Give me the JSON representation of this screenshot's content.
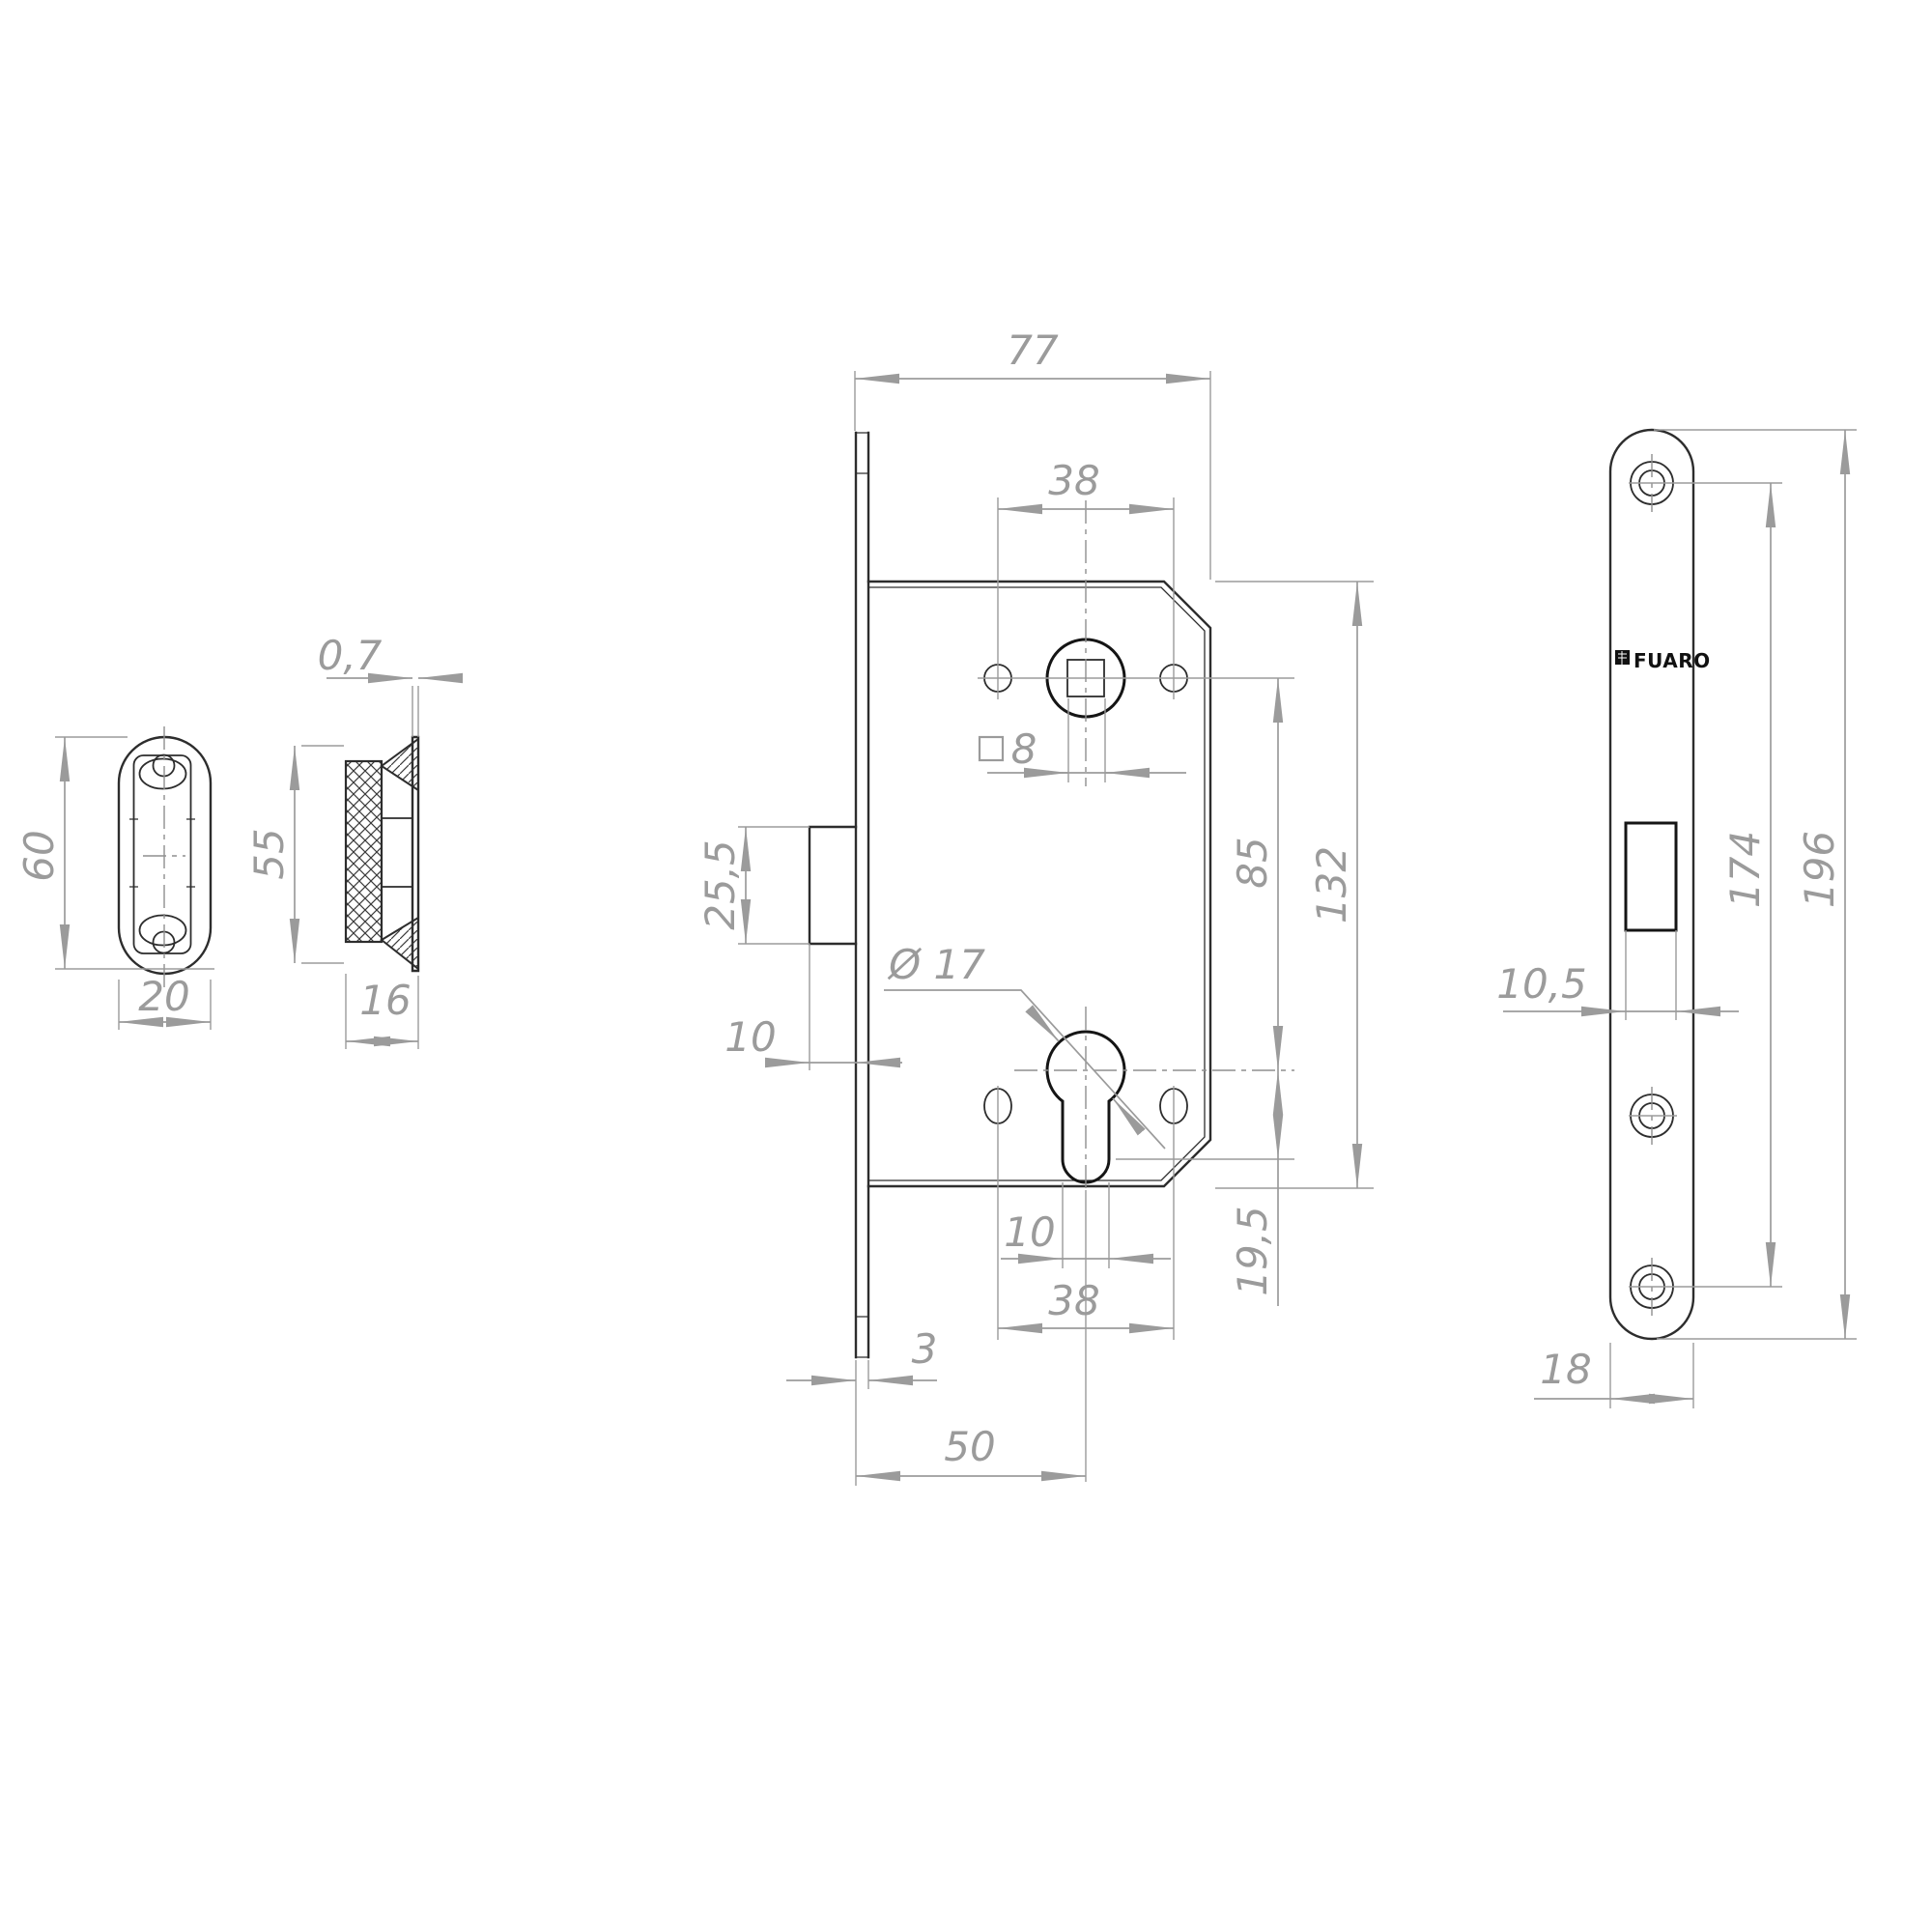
{
  "brand": {
    "logo_text": "FUARO"
  },
  "dims": {
    "strike_front": {
      "height": "60",
      "width": "20"
    },
    "strike_side": {
      "lip_thickness": "0,7",
      "height": "55",
      "depth": "16"
    },
    "lock_body": {
      "width": "77",
      "handle_holes_spacing": "38",
      "spindle_square": "8",
      "latch_height": "25,5",
      "latch_protrusion": "10",
      "cylinder_diameter": "Ø 17",
      "spindle_to_cylinder": "85",
      "height": "132",
      "cylinder_stem_width": "10",
      "cylinder_holes_spacing": "38",
      "cylinder_bottom_offset": "19,5",
      "faceplate_thickness": "3",
      "backset": "50"
    },
    "faceplate": {
      "latch_slot_width": "10,5",
      "screw_spacing": "174",
      "length": "196",
      "width": "18"
    }
  }
}
